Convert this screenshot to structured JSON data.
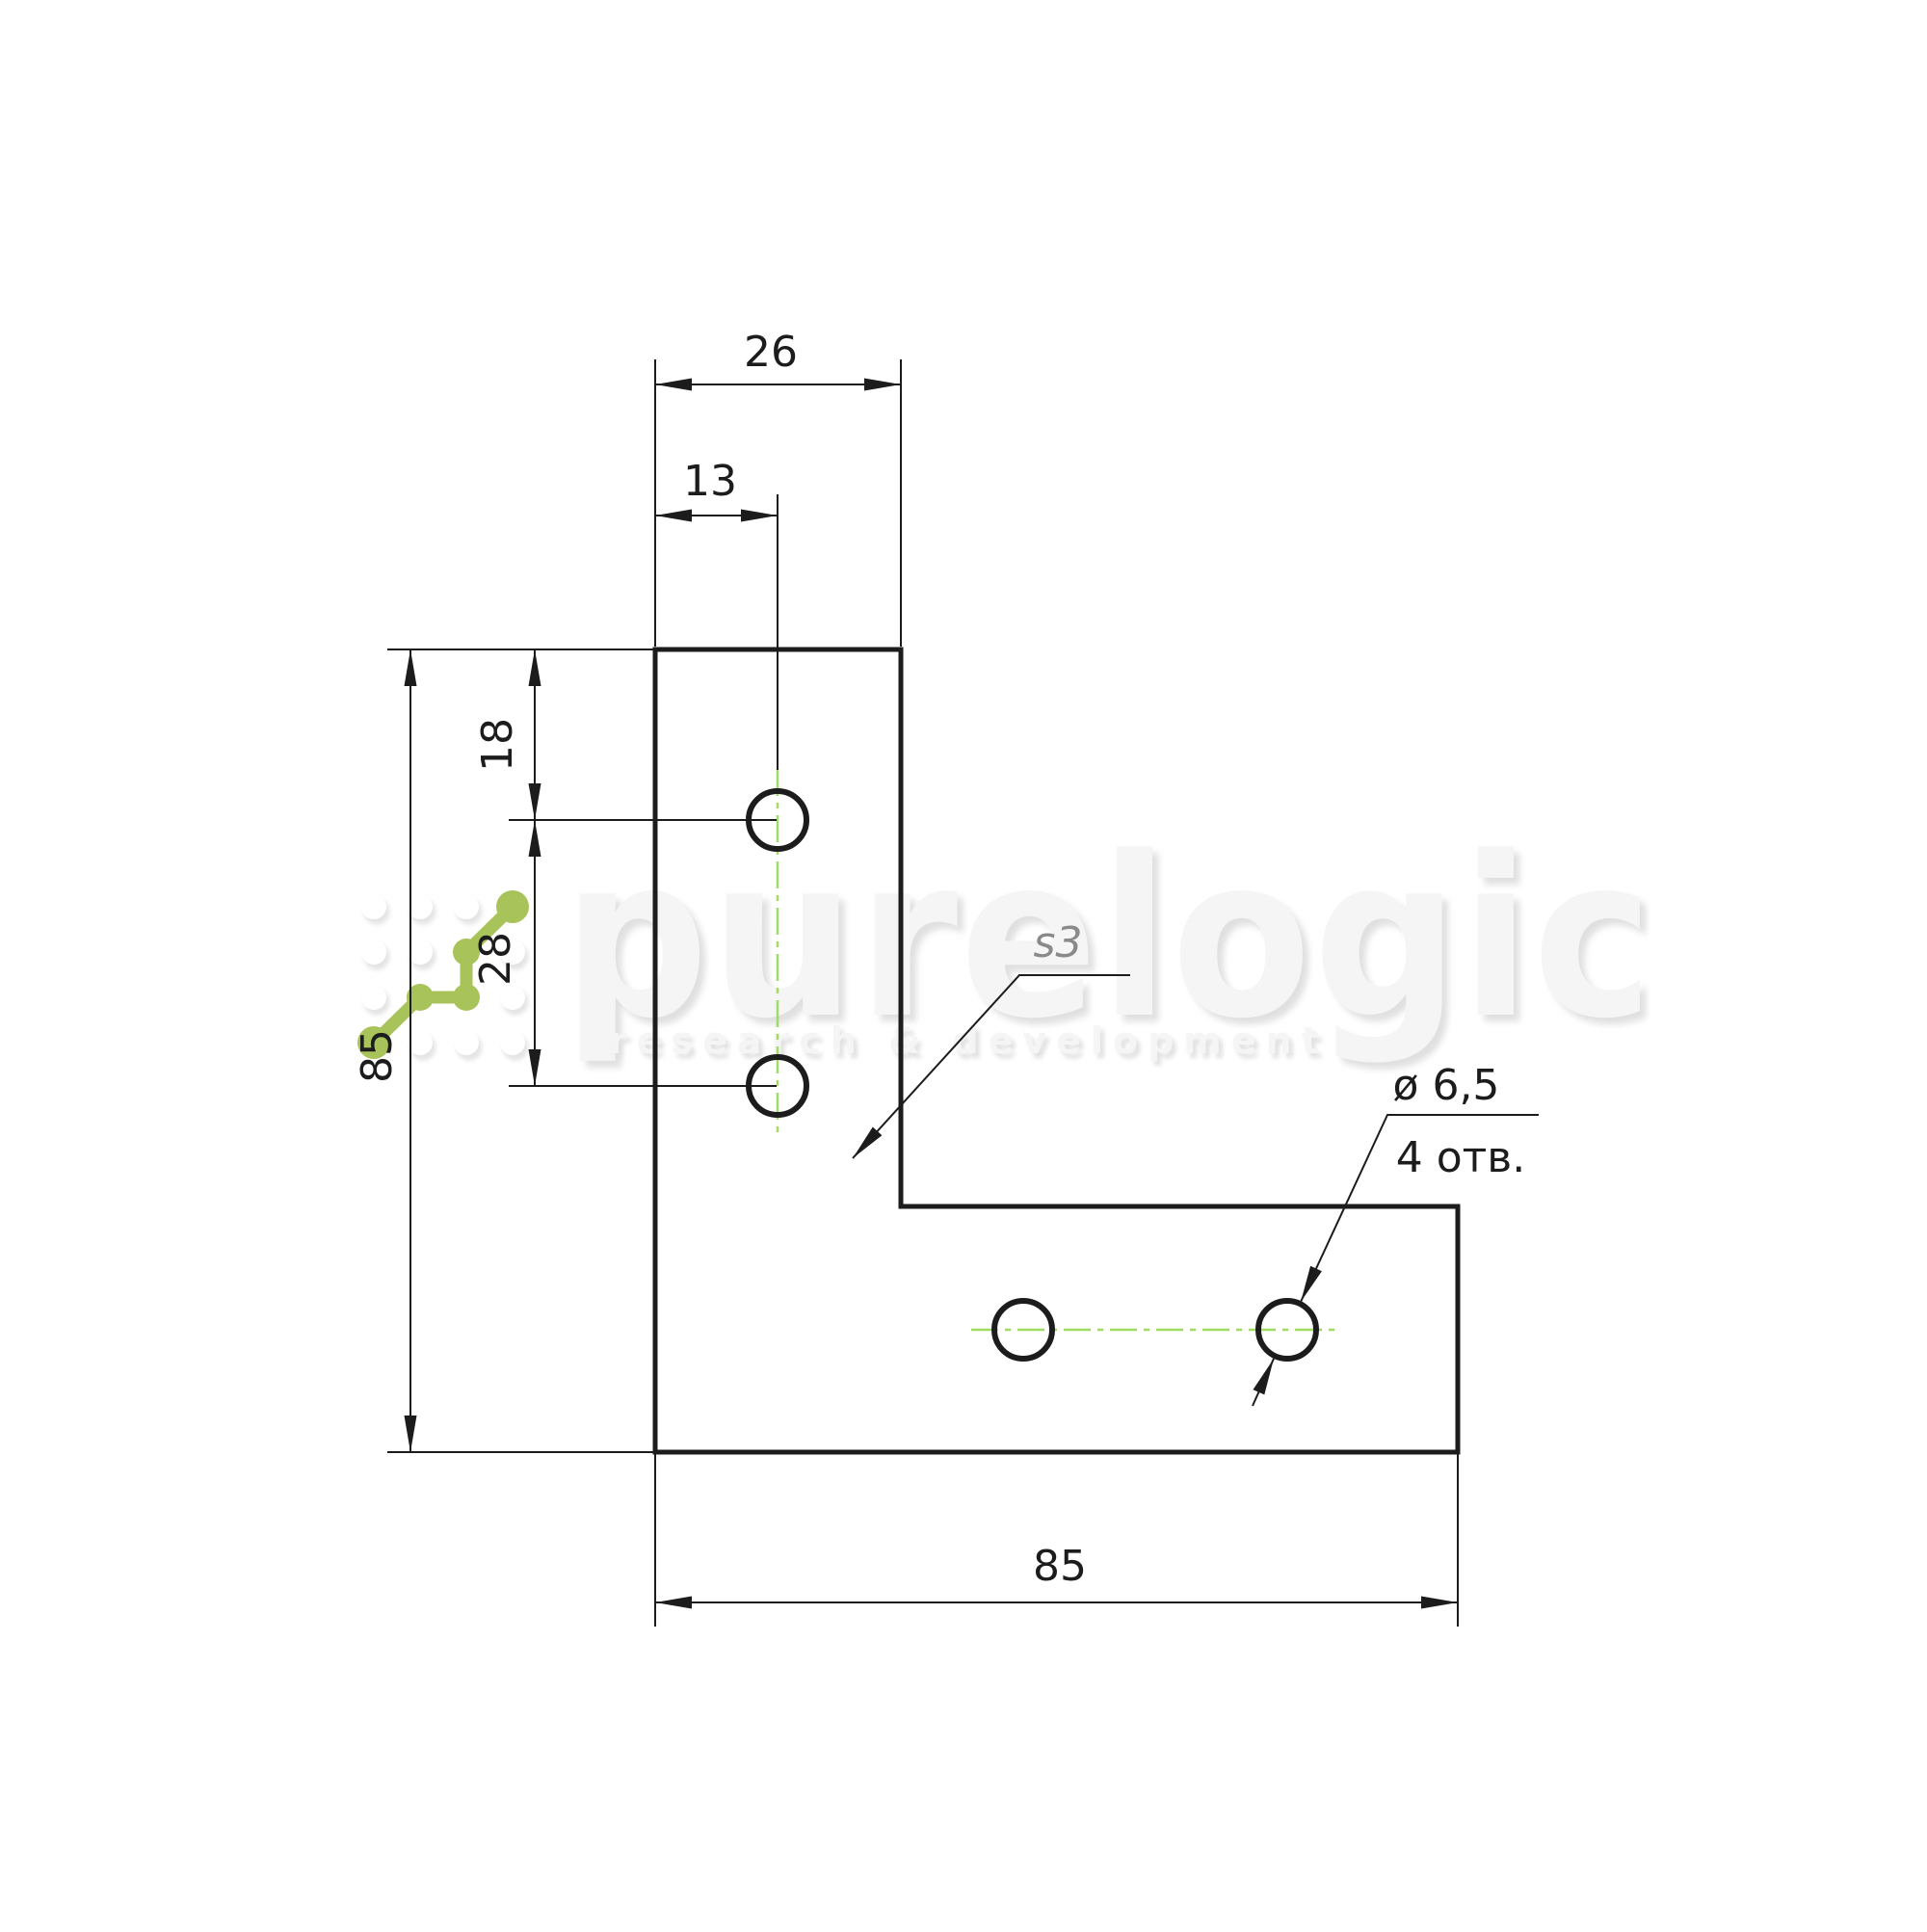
{
  "watermark": {
    "title": "purelogic",
    "subtitle": "research & development"
  },
  "drawing": {
    "part": "L-shaped corner bracket plate, front view",
    "dims": {
      "top_width": "26",
      "hole_offset_x": "13",
      "hole_top_offset": "18",
      "hole_pitch": "28",
      "side_height": "85",
      "bottom_width": "85"
    },
    "labels": {
      "thickness": "s3",
      "hole_diameter": "ø 6,5",
      "hole_count": "4 отв."
    },
    "colors": {
      "line": "#1c1c1c",
      "centerline": "#a0dc64",
      "logo_green": "#a8c35a",
      "watermark": "#f5f5f5",
      "watermark_shadow": "#e0e0e0"
    }
  }
}
